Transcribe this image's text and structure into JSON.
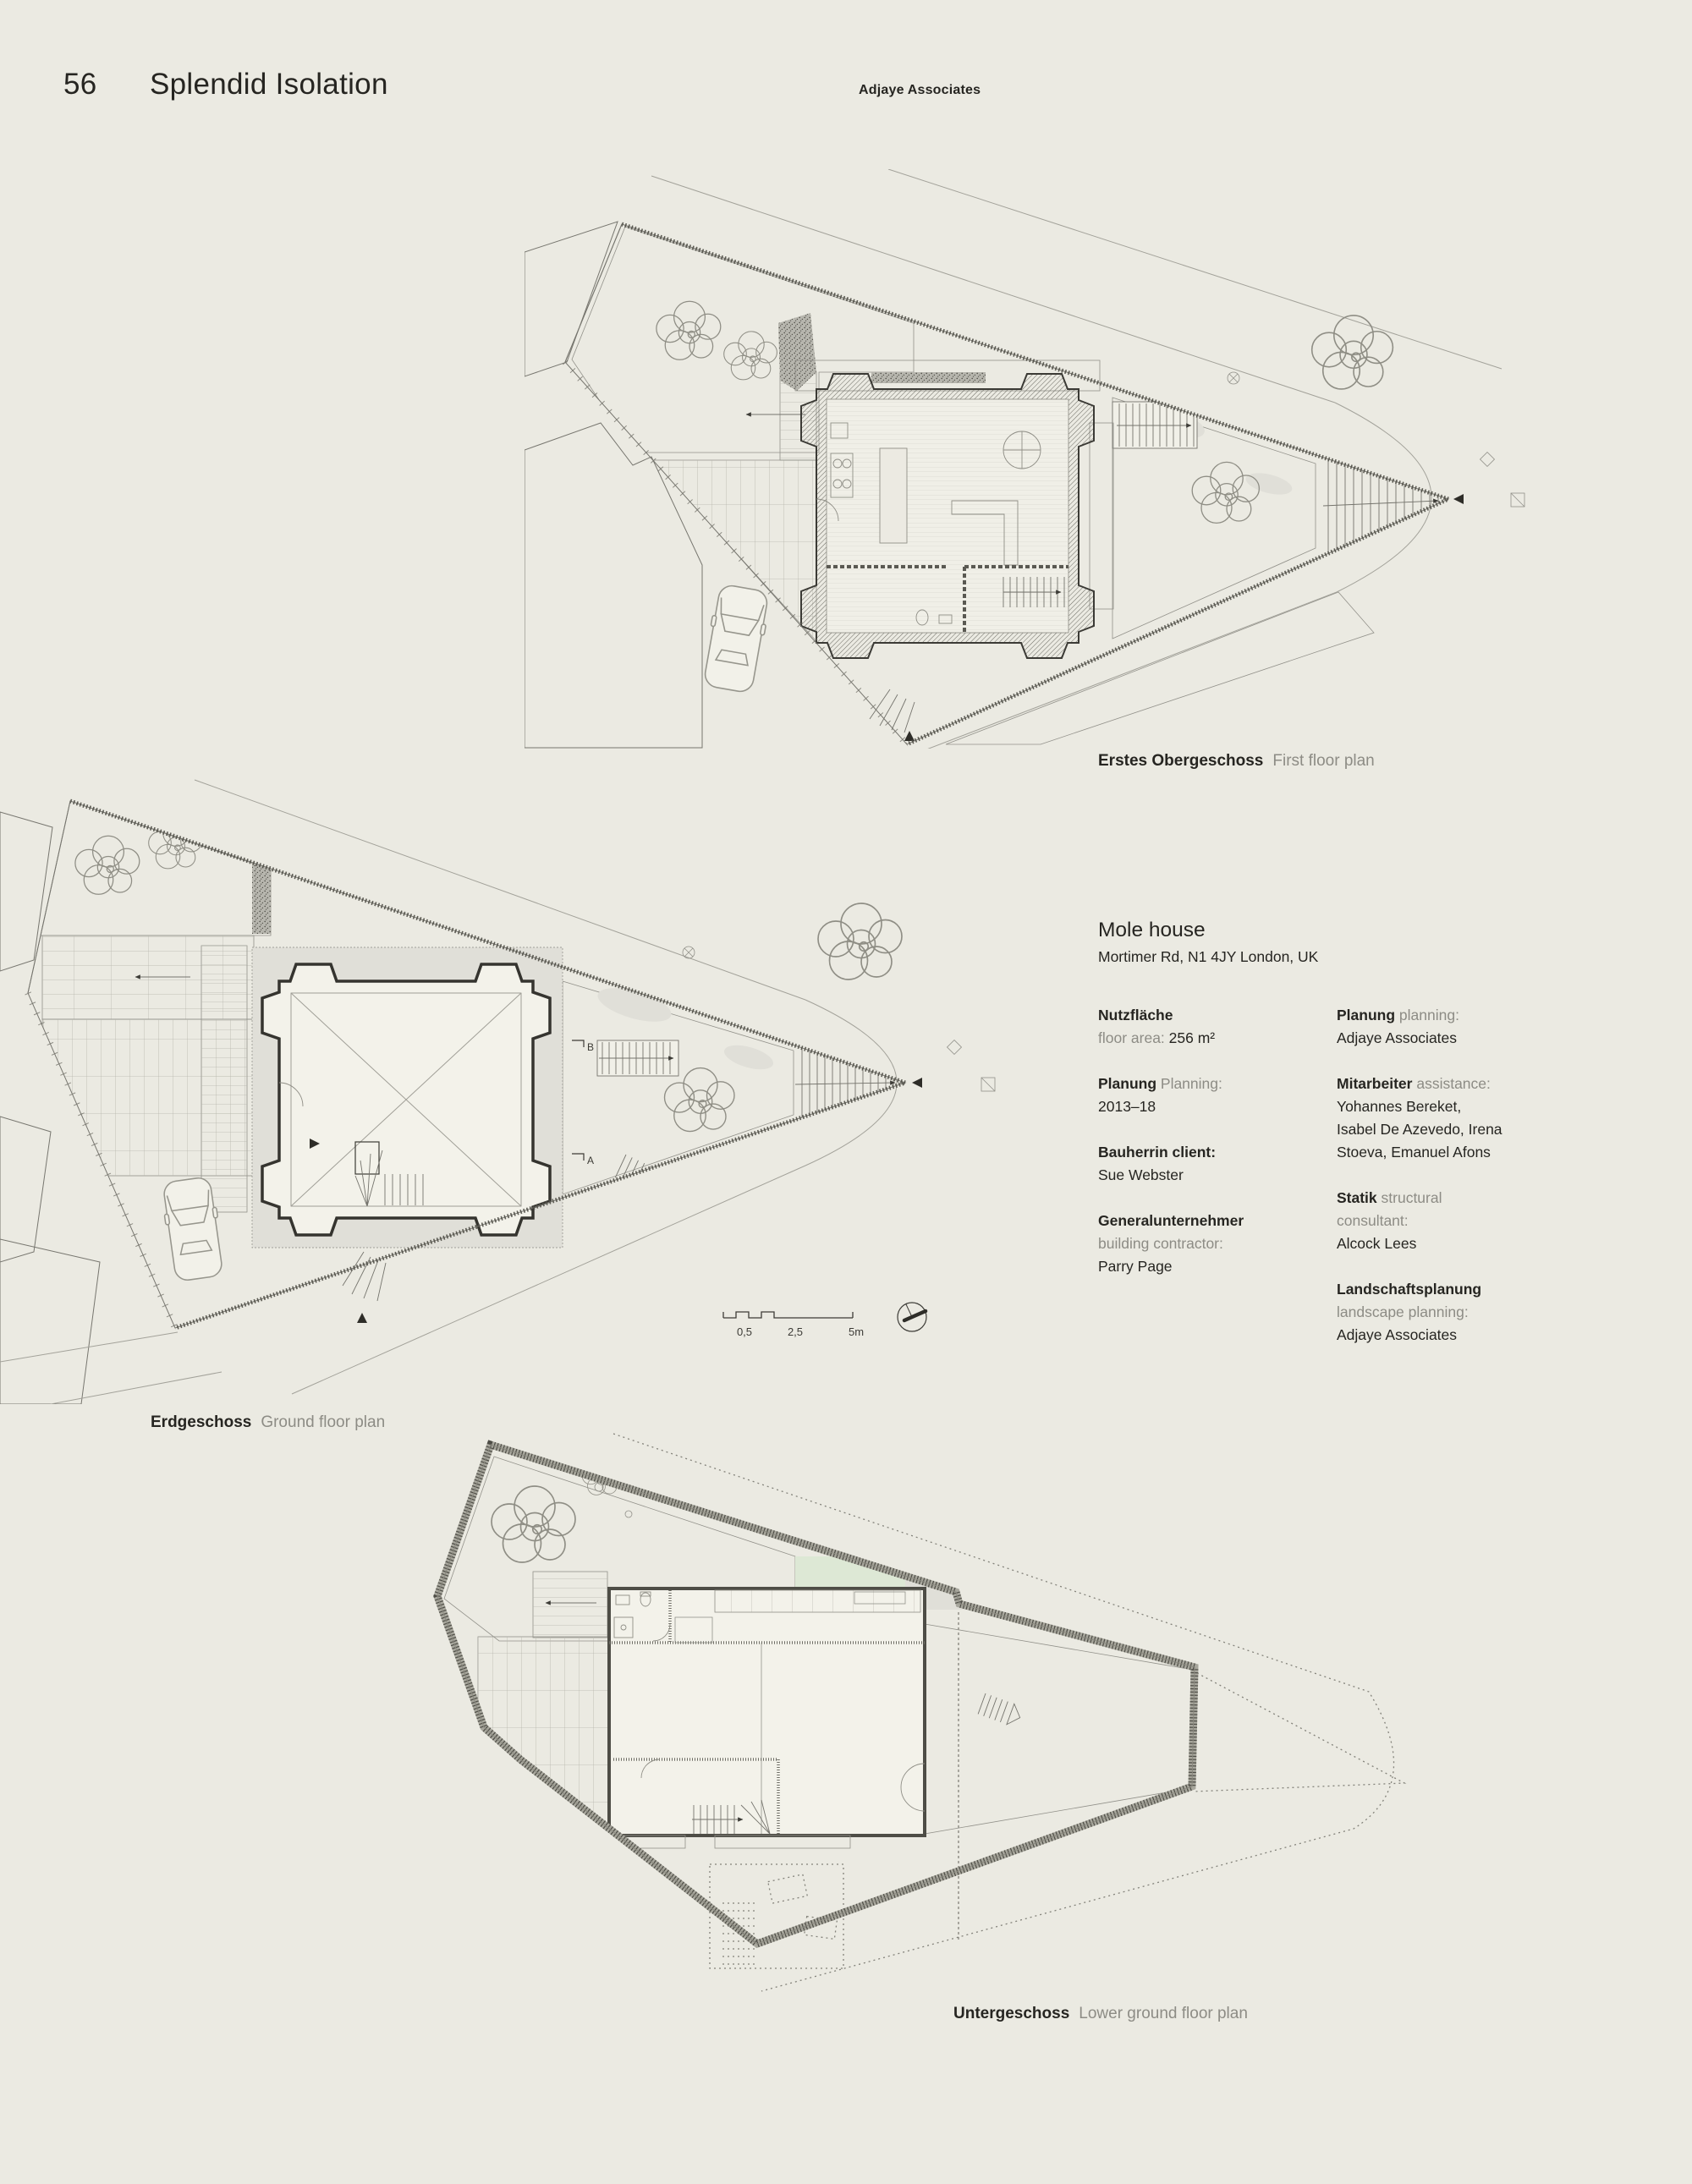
{
  "page": {
    "number": "56",
    "title": "Splendid Isolation",
    "header": "Adjaye Associates"
  },
  "figures": {
    "first_floor": {
      "caption_de": "Erstes Obergeschoss",
      "caption_en": "First floor plan"
    },
    "ground_floor": {
      "caption_de": "Erdgeschoss",
      "caption_en": "Ground floor plan",
      "section_marker_b": "B",
      "section_marker_a": "A"
    },
    "lower_ground": {
      "caption_de": "Untergeschoss",
      "caption_en": "Lower ground floor plan"
    }
  },
  "scale_bar": {
    "labels": [
      "0,5",
      "2,5",
      "5m"
    ]
  },
  "project": {
    "title": "Mole house",
    "address": "Mortimer Rd, N1 4JY London, UK",
    "columns": [
      [
        [
          [
            {
              "t": "Nutzfläche",
              "s": "de"
            }
          ],
          [
            {
              "t": "floor area: ",
              "s": "en"
            },
            {
              "t": "256 m²",
              "s": "val"
            }
          ]
        ],
        [
          [
            {
              "t": "Planung",
              "s": "de"
            },
            {
              "t": " Planning:",
              "s": "en"
            }
          ],
          [
            {
              "t": "2013–18",
              "s": "val"
            }
          ]
        ],
        [
          [
            {
              "t": "Bauherrin client:",
              "s": "de"
            }
          ],
          [
            {
              "t": "Sue Webster",
              "s": "val"
            }
          ]
        ],
        [
          [
            {
              "t": "Generalunternehmer",
              "s": "de"
            }
          ],
          [
            {
              "t": "building contractor:",
              "s": "en"
            }
          ],
          [
            {
              "t": "Parry Page",
              "s": "val"
            }
          ]
        ]
      ],
      [
        [
          [
            {
              "t": "Planung",
              "s": "de"
            },
            {
              "t": " planning:",
              "s": "en"
            }
          ],
          [
            {
              "t": "Adjaye Associates",
              "s": "val"
            }
          ]
        ],
        [
          [
            {
              "t": "Mitarbeiter",
              "s": "de"
            },
            {
              "t": " assistance:",
              "s": "en"
            }
          ],
          [
            {
              "t": "Yohannes Bereket,",
              "s": "val"
            }
          ],
          [
            {
              "t": "Isabel De Azevedo, Irena",
              "s": "val"
            }
          ],
          [
            {
              "t": "Stoeva, Emanuel Afons",
              "s": "val"
            }
          ]
        ],
        [
          [
            {
              "t": "Statik",
              "s": "de"
            },
            {
              "t": " structural",
              "s": "en"
            }
          ],
          [
            {
              "t": "consultant:",
              "s": "en"
            }
          ],
          [
            {
              "t": "Alcock Lees",
              "s": "val"
            }
          ]
        ],
        [
          [
            {
              "t": "Landschaftsplanung",
              "s": "de"
            }
          ],
          [
            {
              "t": "landscape planning:",
              "s": "en"
            }
          ],
          [
            {
              "t": "Adjaye Associates",
              "s": "val"
            }
          ]
        ]
      ]
    ]
  },
  "colors": {
    "page_bg": "#ebeae2",
    "text_dark": "#262521",
    "text_gray": "#8d8c85",
    "green": "#c9dcc1",
    "green_pale": "#dde8d5",
    "gray_fill": "#d8d7cf",
    "gray_fill2": "#e0dfd8",
    "tile_fill": "#f1f0e8",
    "line": "#77766f",
    "wall_dark": "#3c3b35"
  }
}
